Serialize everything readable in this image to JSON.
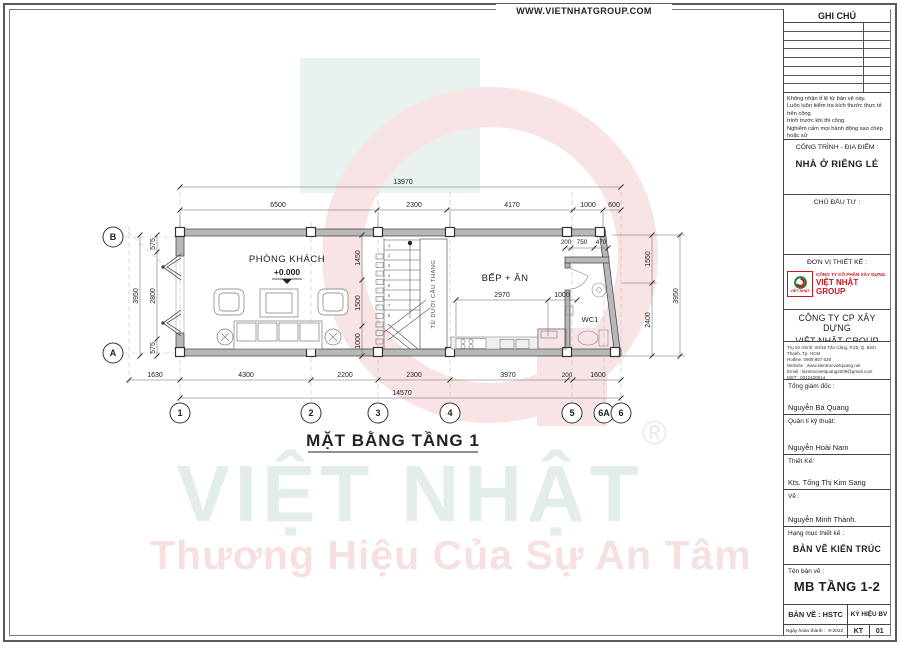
{
  "header": {
    "website": "WWW.VIETNHATGROUP.COM"
  },
  "plan": {
    "title": "MẶT BẰNG TẦNG 1",
    "rooms": {
      "living": "PHÒNG KHÁCH",
      "level": "+0.000",
      "kitchen": "BẾP + ĂN",
      "wc": "WC1",
      "stair_closet": "TỦ DƯỚI CẦU THANG"
    },
    "grid_rows": [
      "B",
      "A"
    ],
    "grid_cols": [
      "1",
      "2",
      "3",
      "4",
      "5",
      "6A",
      "6"
    ],
    "stair_steps": [
      "1",
      "2",
      "3",
      "4",
      "5",
      "6",
      "7",
      "8"
    ],
    "dims": {
      "top_overall": "13970",
      "top": [
        "6500",
        "2300",
        "4170",
        "1000",
        "600"
      ],
      "bottom": [
        "1630",
        "4300",
        "2200",
        "2300",
        "3970",
        "200",
        "1600"
      ],
      "bottom_overall": "14570",
      "left_overall": "3950",
      "left": [
        "575",
        "2800",
        "575"
      ],
      "inner": [
        "1450",
        "1500",
        "1000"
      ],
      "right": [
        "1550",
        "2400"
      ],
      "right_overall": "3950",
      "wc": [
        "200",
        "750",
        "470"
      ],
      "kitchen": [
        "2970",
        "1000"
      ]
    }
  },
  "watermark": {
    "brand": "VIỆT NHẬT",
    "reg": "®",
    "tagline": "Thương Hiệu Của Sự An Tâm"
  },
  "titleblock": {
    "notes_title": "GHI CHÚ",
    "notes": [
      "Không nhận tỉ lệ từ bản vẽ này.",
      "Luôn luôn kiểm tra kích thước thực tế trên công",
      "trình trước khi thi công.",
      "Nghiêm cấm mọi hành động sao chép hoặc sử",
      "dụng lại thông tin từ bản vẽ này mà không được",
      "sự cho phép của Công ty Kiến Trúc Việt Quang."
    ],
    "project_label": "CÔNG TRÌNH - ĐỊA ĐIỂM :",
    "project_value": "NHÀ Ở RIÊNG LẺ",
    "owner_label": "CHỦ ĐẦU TƯ :",
    "designer_label": "ĐƠN VỊ THIẾT KẾ :",
    "logo": {
      "caption": "VIỆT NHẬT",
      "line1": "CÔNG TY CỔ PHẦN XÂY DỰNG",
      "line2": "VIỆT NHẬT GROUP"
    },
    "company_line1": "CÔNG TY CP XÂY DỰNG",
    "company_line2": "VIỆT NHẬT GROUP",
    "contact": [
      "Trụ sở chính: 20/18 Tân Cảng, P.25, Q. Bình Thạnh, Tp. HCM",
      "Hotline: 0909 857 629",
      "Website : www.kientrucvietquang.net",
      "Email : kientrucvietquang2009@gmail.com",
      "MST : 0312420514"
    ],
    "roles": [
      {
        "label": "Tổng giám đốc :",
        "name": "Nguyễn Bá Quang"
      },
      {
        "label": "Quản lí kỹ thuật:",
        "name": "Nguyễn Hoài Nam"
      },
      {
        "label": "Thiết Kế:",
        "name": "Kts. Tống Thị Kim Sang"
      },
      {
        "label": "Vẽ :",
        "name": "Nguyễn Minh Thành."
      }
    ],
    "category_label": "Hạng mục thiết kế :",
    "category_value": "BẢN VẼ KIẾN TRÚC",
    "sheet_label": "Tên bản vẽ :",
    "sheet_value": "MB TẦNG 1-2",
    "type_label": "BẢN VẼ : HSTC",
    "symbol_label": "KÝ HIỆU BV",
    "date_label": "Ngày hoàn thành :",
    "date_value": "9-2022",
    "code": "KT",
    "number": "01"
  },
  "colors": {
    "accent_red": "#c4161c",
    "logo_green": "#1d7a3f",
    "watermark_teal": "#e3eeea",
    "watermark_pink": "#f7e0e0",
    "line": "#3a3a3a",
    "wall_fill": "#b8b8b8"
  }
}
